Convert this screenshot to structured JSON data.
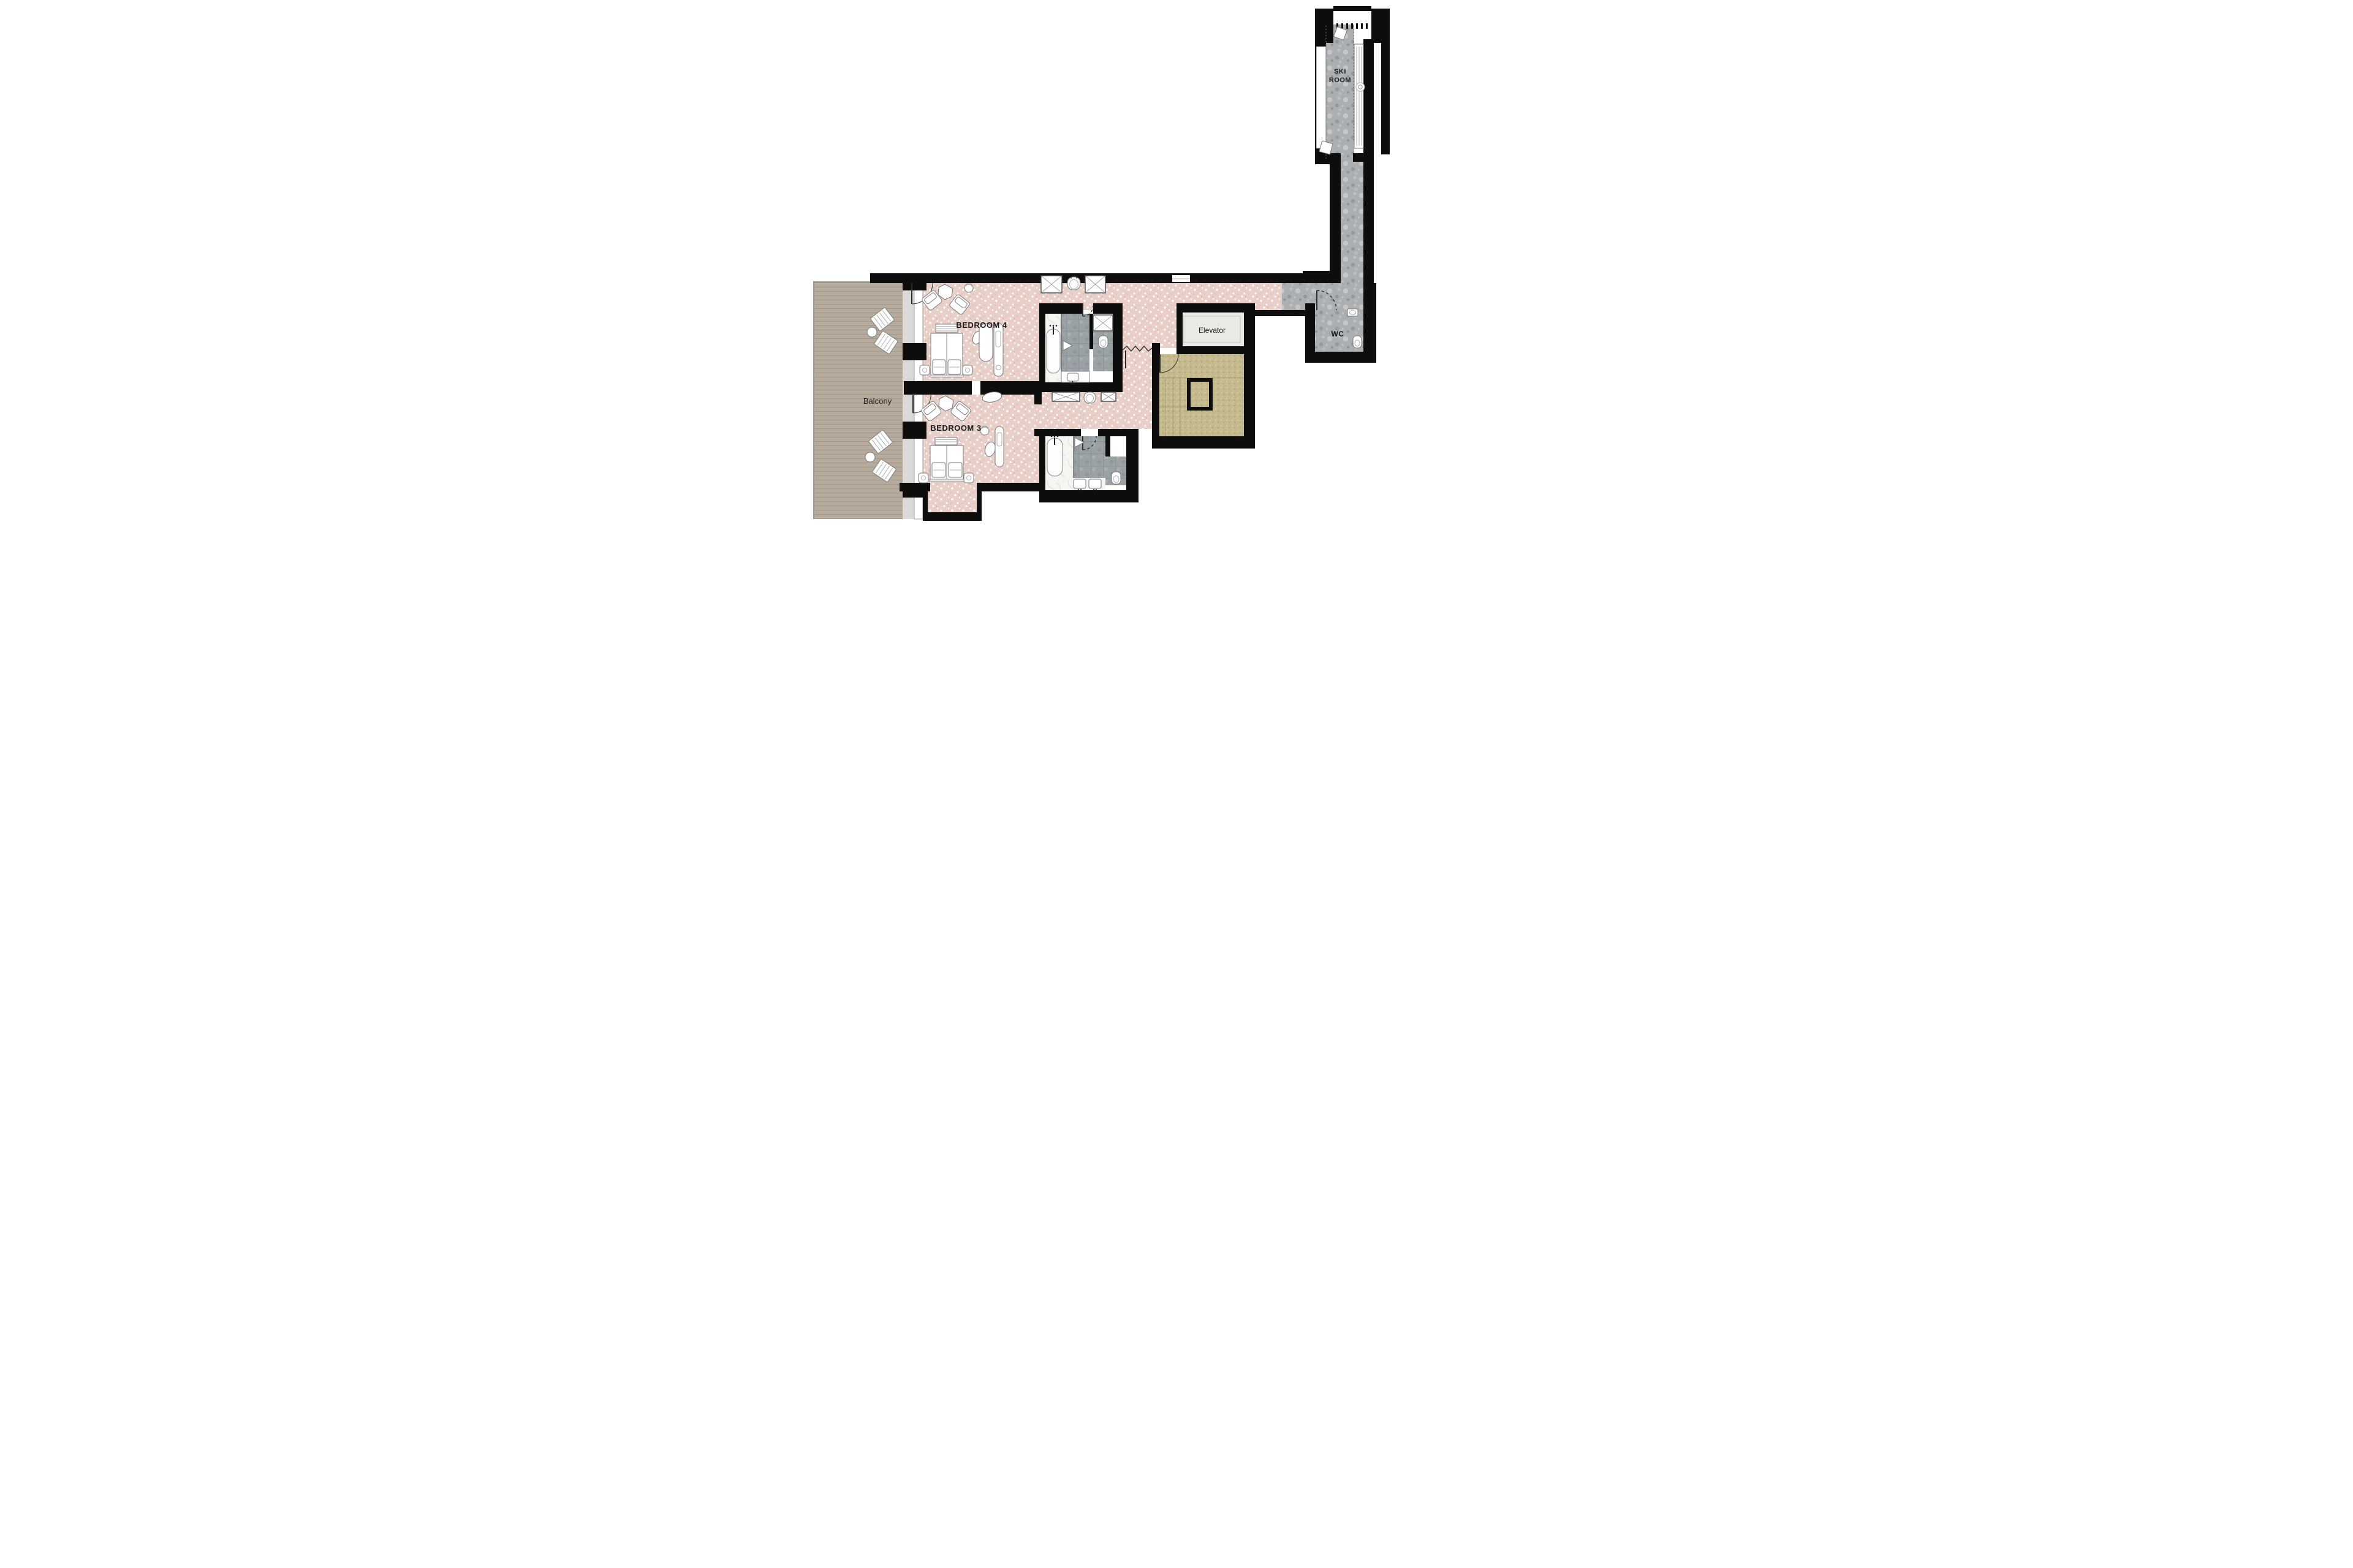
{
  "plan": {
    "labels": {
      "ski_room_line1": "SKI",
      "ski_room_line2": "ROOM",
      "wc": "WC",
      "elevator": "Elevator",
      "balcony": "Balcony",
      "bedroom4": "BEDROOM 4",
      "bedroom3": "BEDROOM 3"
    },
    "colors": {
      "wall": "#0d0d0d",
      "terrazzo_pink": "#e8d0c9",
      "stone_gray": "#abafb2",
      "stair_olive": "#c4ba8d",
      "deck_wood": "#b6aa9d",
      "elevator_floor": "#e9e9e6",
      "tile_gray": "#9ba2a6",
      "marble_white": "#f5f5f2",
      "window_sill": "#d9d9d5"
    }
  }
}
